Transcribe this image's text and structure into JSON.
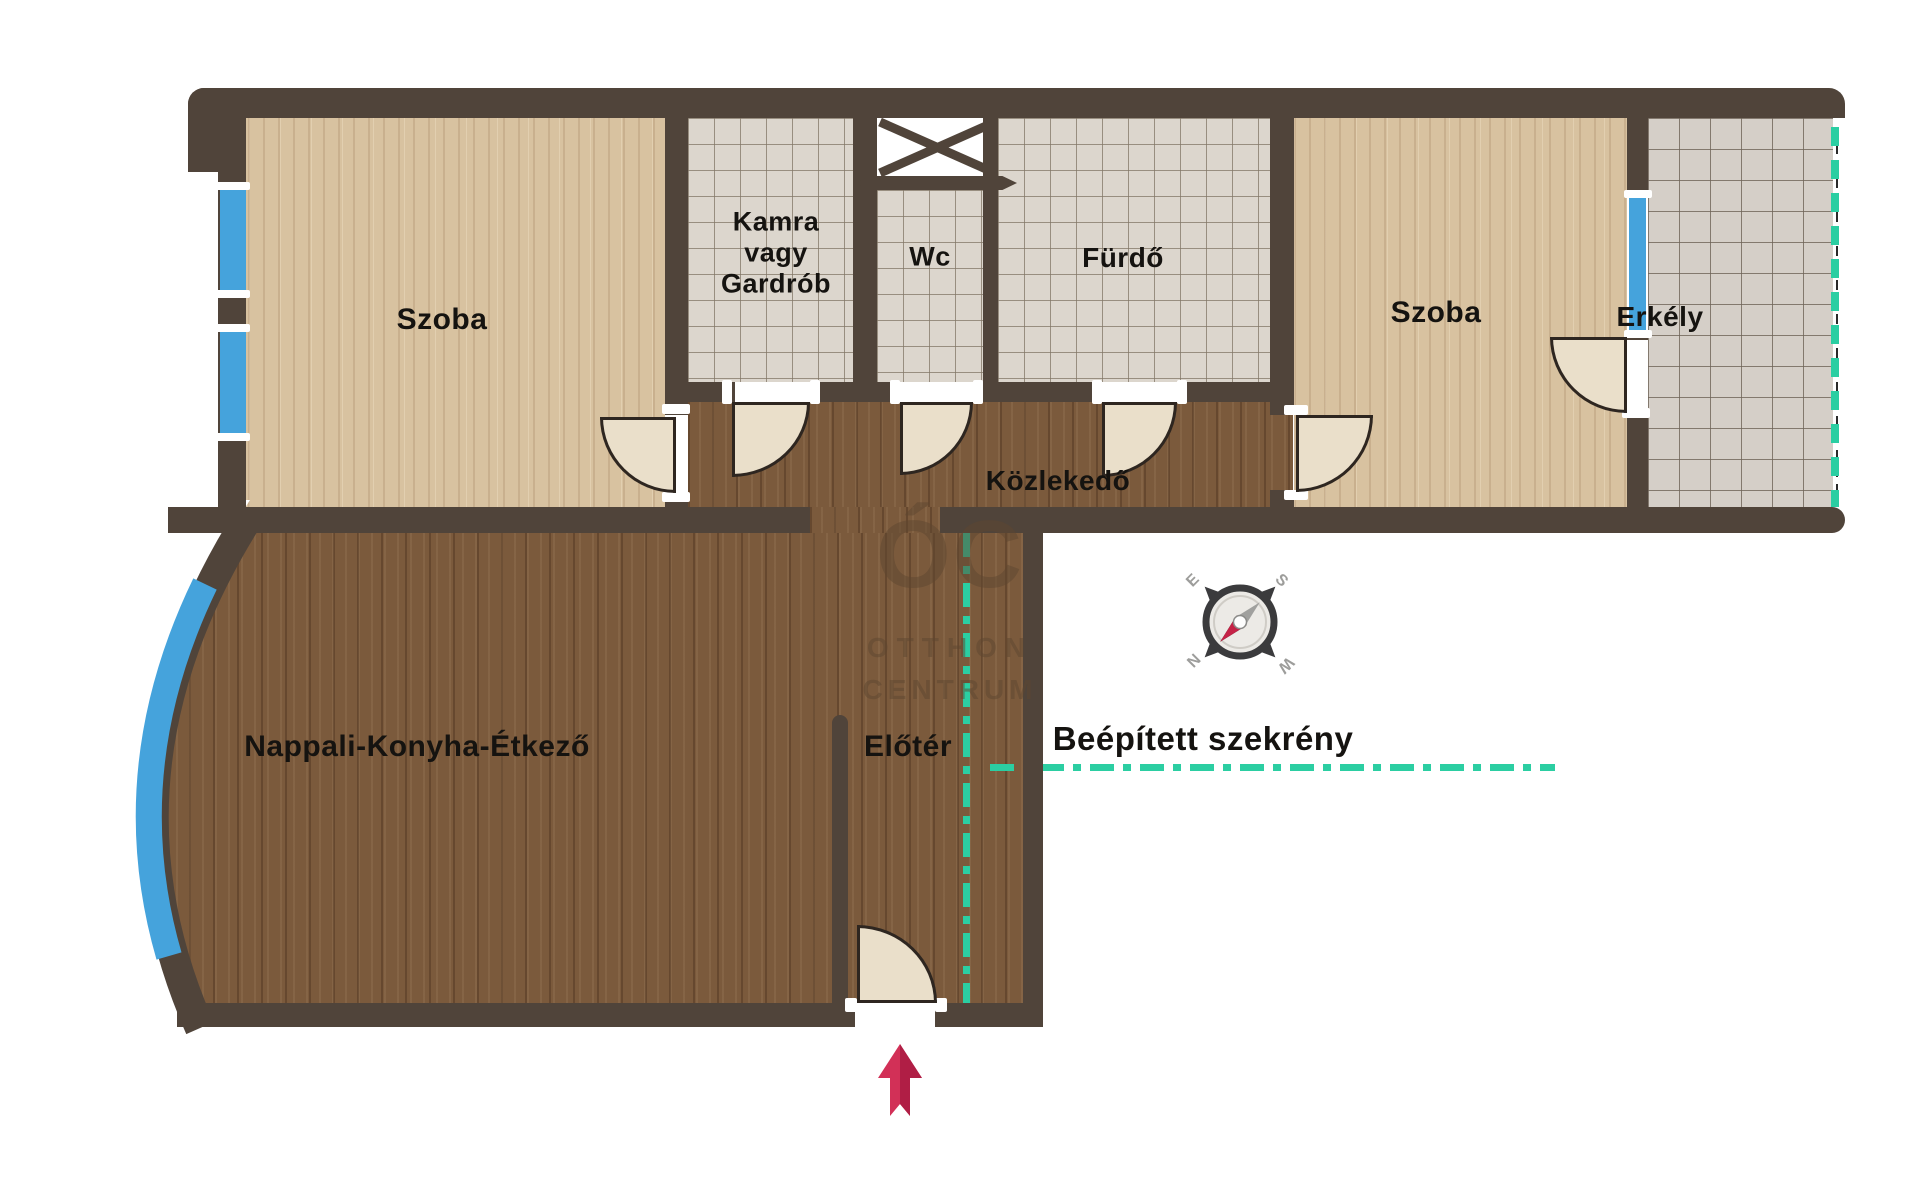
{
  "title": "Apartment floor plan",
  "rooms": {
    "szoba_left": {
      "label": "Szoba"
    },
    "kamra": {
      "line1": "Kamra",
      "line2": "vagy",
      "line3": "Gardrób"
    },
    "wc": {
      "label": "Wc"
    },
    "furdo": {
      "label": "Fürdő"
    },
    "szoba_right": {
      "label": "Szoba"
    },
    "erkely": {
      "label": "Erkély"
    },
    "kozlekedo": {
      "label": "Közlekedő"
    },
    "nappali": {
      "label": "Nappali-Konyha-Étkező"
    },
    "eloter": {
      "label": "Előtér"
    }
  },
  "annotations": {
    "built_in_wardrobe": {
      "label": "Beépített szekrény"
    }
  },
  "compass": {
    "n": "N",
    "s": "S",
    "e": "E",
    "w": "W"
  },
  "watermark": {
    "logo": "ÓC",
    "line1": "OTTHON",
    "line2": "CENTRUM"
  },
  "colors": {
    "wall": "#50443a",
    "window": "#45a3dc",
    "dash": "#2bcea2",
    "arrow": "#d23057",
    "floor_dark": "#7b5a3c",
    "floor_light": "#d8c2a0",
    "tile": "#dcd6cd"
  }
}
